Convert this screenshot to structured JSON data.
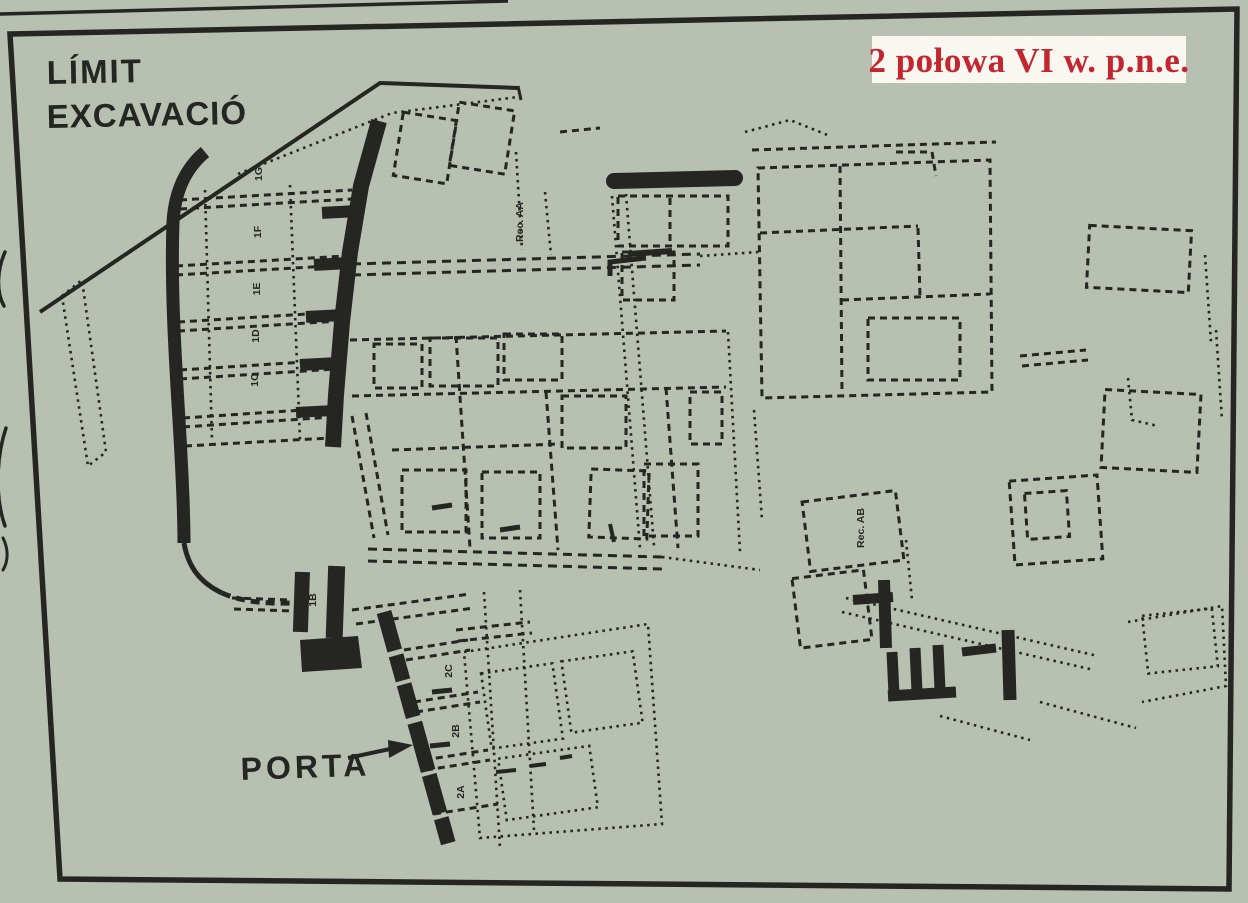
{
  "colors": {
    "paper": "#b7c0b1",
    "ink": "#20211d",
    "badge_bg": "#fbf9f2",
    "badge_red": "#c5202a"
  },
  "badge": {
    "text": "2 połowa VI w. p.n.e."
  },
  "labels": {
    "limit_line1": "LÍMIT",
    "limit_line2": "EXCAVACIÓ",
    "porta": "PORTA",
    "rec_aa": "Rec. AA",
    "rec_ab": "Rec. AB"
  },
  "rooms": {
    "north_wall_rooms": [
      "1G",
      "1F",
      "1E",
      "1D",
      "1C"
    ],
    "gate_rooms": [
      "1B",
      "1A"
    ],
    "south_wall_rooms": [
      "2C",
      "2B",
      "2A"
    ]
  }
}
